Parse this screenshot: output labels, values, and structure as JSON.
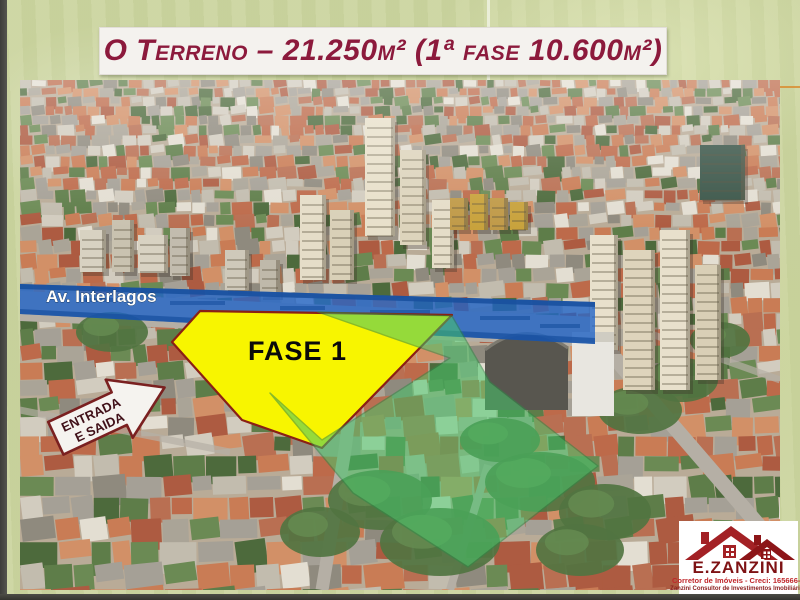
{
  "title": {
    "text": "O Terreno – 21.250m² (1ª fase 10.600m²)"
  },
  "overlays": {
    "avenue_label": "Av. Interlagos",
    "phase_label": "FASE 1",
    "entrance_line1": "ENTRADA",
    "entrance_line2": "E SAIDA"
  },
  "logo": {
    "name": "E.ZANZINI",
    "registration": "Corretor de Imóveis - Creci: 165666-F",
    "tagline": "Zanzini Consultor de Investimentos Imobiliários"
  },
  "colors": {
    "title_text": "#8c1a3c",
    "banner_bg": "#f4f2ee",
    "avenue_fill": "#1e63c8",
    "avenue_dark": "#174f9e",
    "phase_fill": "#f8f500",
    "phase_border": "#8a2015",
    "area_fill": "#46c56a",
    "area_border": "#2f8a47",
    "arrow_fill": "#f5f3ef",
    "arrow_border": "#7a2020",
    "logo_red": "#a32125"
  }
}
